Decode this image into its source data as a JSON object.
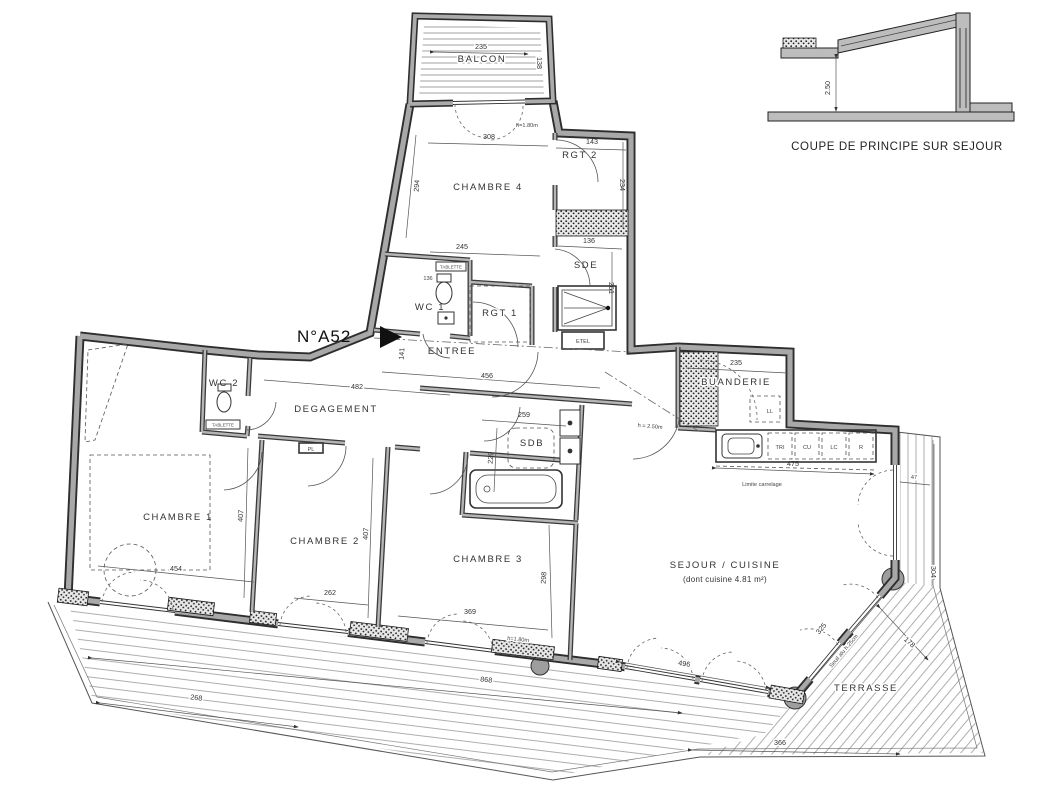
{
  "header": {
    "number": "N°A52"
  },
  "section_detail": {
    "caption": "COUPE DE PRINCIPE SUR SEJOUR",
    "height": "2.50"
  },
  "rooms": {
    "balcon": "BALCON",
    "chambre4": "CHAMBRE 4",
    "rgt2": "RGT 2",
    "sde": "SDE",
    "wc1": "WC 1",
    "rgt1": "RGT 1",
    "etel": "ETEL",
    "entree": "ENTREE",
    "wc2": "WC 2",
    "degagement": "DEGAGEMENT",
    "sdb": "SDB",
    "chambre1": "CHAMBRE 1",
    "chambre2": "CHAMBRE 2",
    "chambre3": "CHAMBRE 3",
    "sejour": "SEJOUR / CUISINE",
    "sejour_sub": "(dont cuisine 4.81 m²)",
    "buanderie": "BUANDERIE",
    "terrasse": "TERRASSE"
  },
  "fixtures": {
    "ll": "LL",
    "pl": "PL",
    "tri": "TRI",
    "cu": "CU",
    "lc": "LC",
    "r": "R",
    "tablette_wc1": "TABLETTE",
    "tablette_wc2": "TABLETTE"
  },
  "annotations": {
    "limite_carrelage": "Limite carrelage",
    "h180_balcon": "h=1.80m",
    "h180_sejour": "h=1.80m",
    "h250": "h = 2.50m",
    "seuil": "Seuil alu h.25cm"
  },
  "dims": {
    "balcon_w": "235",
    "balcon_d": "138",
    "balcon_door": "308",
    "rgt2_w": "143",
    "rgt2_h": "234",
    "ch4_h": "294",
    "ch4_w": "245",
    "wc1_w": "136",
    "sde_w": "136",
    "sde_h": "261",
    "entree_h": "141",
    "entree_w": "456",
    "deg_w": "482",
    "sdb_w": "259",
    "sdb_h": "229",
    "ch1_w": "454",
    "ch1_h": "407",
    "ch2_w": "262",
    "ch2_h": "407",
    "ch3_w": "369",
    "ch3_h": "298",
    "cuisine_w": "475",
    "buanderie_w": "235",
    "terr_a": "268",
    "terr_b": "868",
    "terr_c": "496",
    "terr_d": "366",
    "terr_e": "325",
    "terr_f": "178",
    "terr_g": "304",
    "terr_h": "47"
  },
  "colors": {
    "wall_fill": "#a8a8a8",
    "line": "#333333",
    "paper": "#ffffff"
  }
}
